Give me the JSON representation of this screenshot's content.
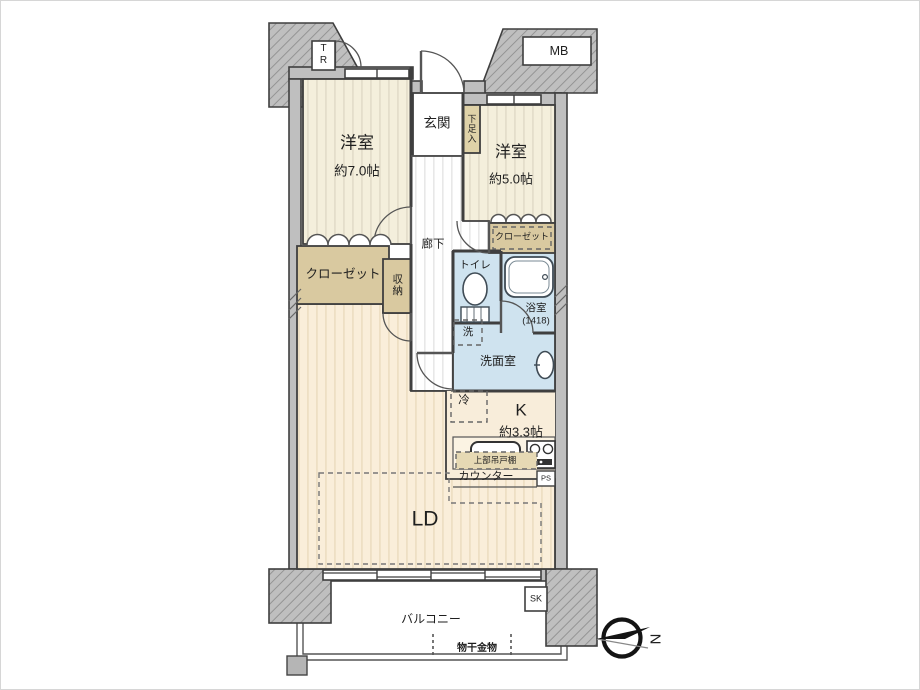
{
  "fp": {
    "title": "apartment-floorplan",
    "rooms": {
      "bedroom_left": {
        "name": "洋室",
        "size": "約7.0帖"
      },
      "bedroom_right": {
        "name": "洋室",
        "size": "約5.0帖"
      },
      "entrance": {
        "name": "玄関"
      },
      "shoe_box": {
        "name": "下足入"
      },
      "hallway": {
        "name": "廊下"
      },
      "closet_left": {
        "name": "クローゼット"
      },
      "closet_right": {
        "name": "クローゼット"
      },
      "storage": {
        "name": "収納"
      },
      "toilet": {
        "name": "トイレ"
      },
      "bathroom": {
        "name": "浴室",
        "size": "(1418)"
      },
      "washer_space": {
        "name": "洗"
      },
      "washroom": {
        "name": "洗面室"
      },
      "refrigerator": {
        "name": "冷"
      },
      "kitchen": {
        "name": "K",
        "size": "約3.3帖"
      },
      "hanging_cupboard": {
        "name": "上部吊戸棚"
      },
      "counter": {
        "name": "カウンター"
      },
      "pipe_space": {
        "name": "PS"
      },
      "living_dining": {
        "name": "LD"
      },
      "balcony": {
        "name": "バルコニー"
      },
      "laundry_hardware": {
        "name": "物干金物"
      },
      "slop_sink": {
        "name": "SK"
      },
      "meter_box": {
        "name": "MB"
      },
      "trunk_room": {
        "name": "TR"
      }
    },
    "compass": {
      "north_label": "N"
    },
    "colors": {
      "wall_gray": "#bfbfbf",
      "room_cream": "#f4efdc",
      "living_cream": "#faeeda",
      "kitchen_cream": "#f8edda",
      "water_blue": "#cfe3ef",
      "closet_tan": "#d9c9a0",
      "line_dark": "#3f3f3f"
    }
  }
}
